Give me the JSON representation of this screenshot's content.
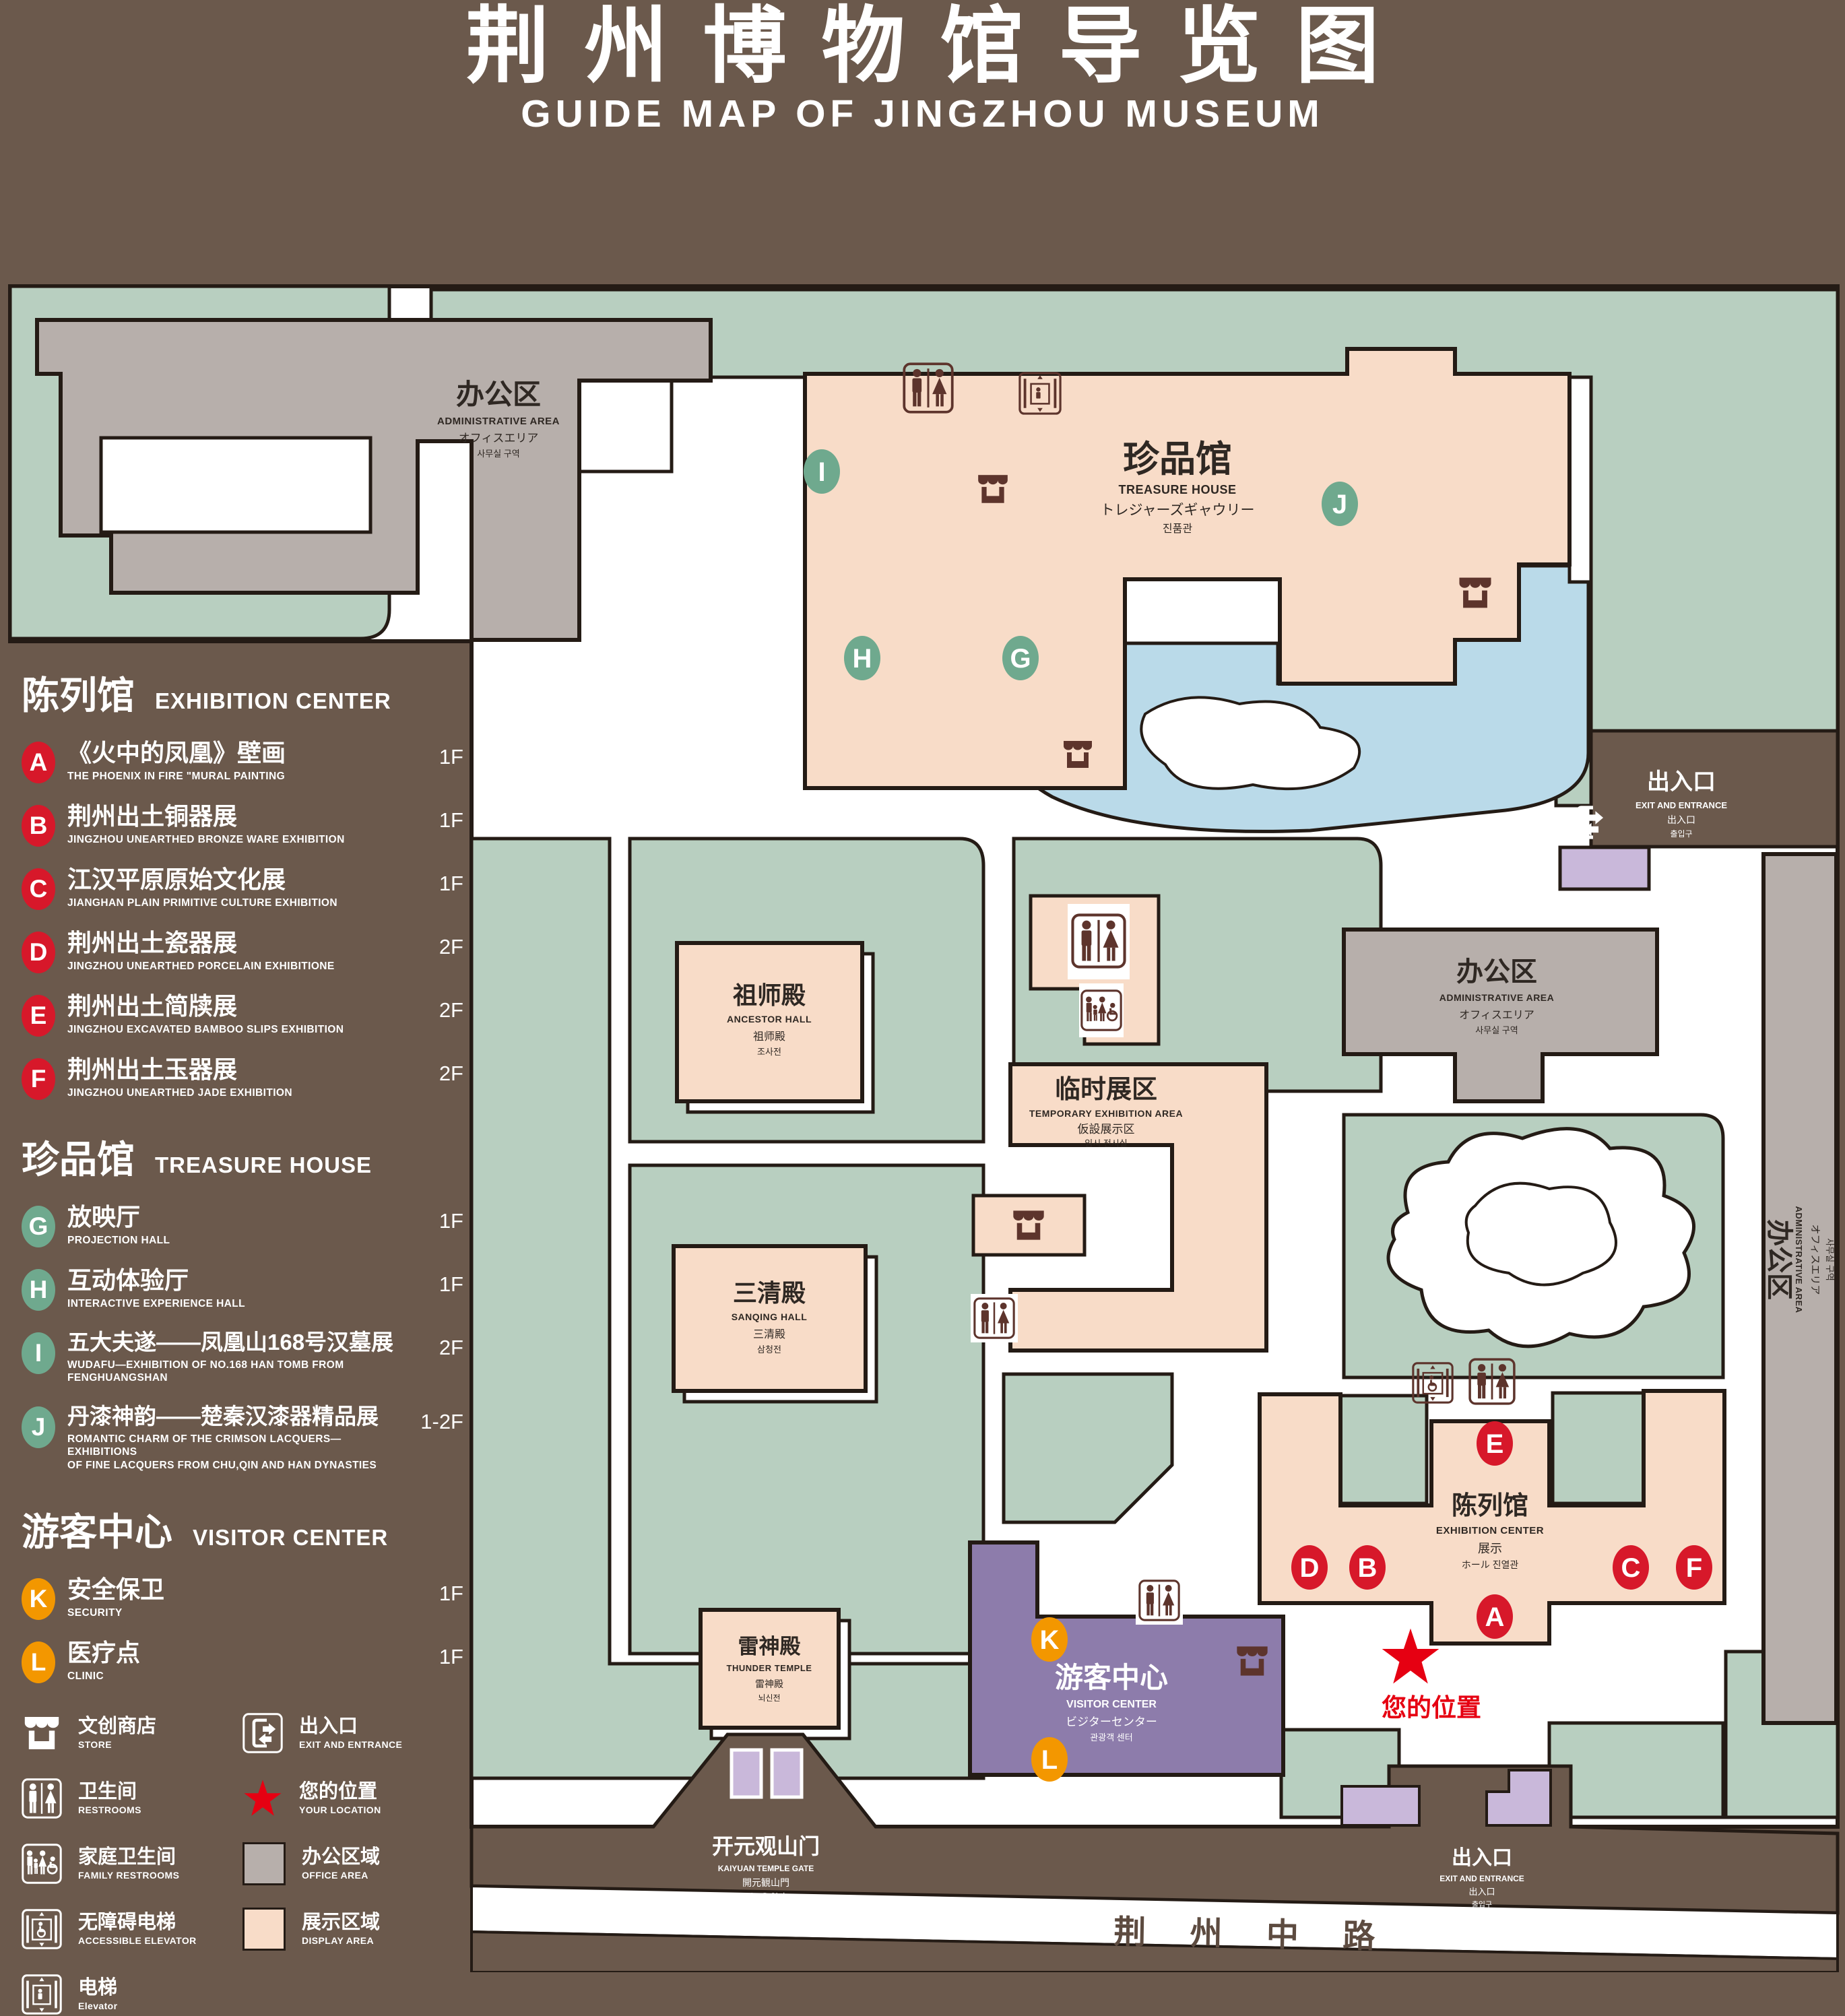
{
  "header": {
    "title": "荆州博物馆导览图",
    "subtitle": "GUIDE MAP OF JINGZHOU MUSEUM"
  },
  "colors": {
    "background_brown": "#6b594c",
    "park_green": "#b8cfc0",
    "display_area_peach": "#f8dcc8",
    "office_area_gray": "#b7afab",
    "visitor_center_purple": "#8d7cab",
    "entrance_lavender": "#c9b8da",
    "pond_blue": "#badae9",
    "badge_red": "#d7182a",
    "badge_green": "#6fa98e",
    "badge_orange": "#f39700",
    "location_red": "#e60012",
    "icon_brown": "#5d342c"
  },
  "legend": {
    "sections": [
      {
        "zh": "陈列馆",
        "en": "EXHIBITION CENTER",
        "items": [
          {
            "letter": "A",
            "title": "《火中的凤凰》壁画",
            "sub": "THE PHOENIX IN FIRE \"MURAL PAINTING",
            "floor": "1F"
          },
          {
            "letter": "B",
            "title": "荆州出土铜器展",
            "sub": "JINGZHOU UNEARTHED BRONZE WARE EXHIBITION",
            "floor": "1F"
          },
          {
            "letter": "C",
            "title": "江汉平原原始文化展",
            "sub": "JIANGHAN PLAIN PRIMITIVE CULTURE EXHIBITION",
            "floor": "1F"
          },
          {
            "letter": "D",
            "title": "荆州出土瓷器展",
            "sub": "JINGZHOU UNEARTHED PORCELAIN EXHIBITIONE",
            "floor": "2F"
          },
          {
            "letter": "E",
            "title": "荆州出土简牍展",
            "sub": "JINGZHOU EXCAVATED BAMBOO SLIPS EXHIBITION",
            "floor": "2F"
          },
          {
            "letter": "F",
            "title": "荆州出土玉器展",
            "sub": "JINGZHOU UNEARTHED JADE EXHIBITION",
            "floor": "2F"
          }
        ]
      },
      {
        "zh": "珍品馆",
        "en": "TREASURE HOUSE",
        "items": [
          {
            "letter": "G",
            "title": "放映厅",
            "sub": "PROJECTION HALL",
            "floor": "1F"
          },
          {
            "letter": "H",
            "title": "互动体验厅",
            "sub": "INTERACTIVE EXPERIENCE HALL",
            "floor": "1F"
          },
          {
            "letter": "I",
            "title": "五大夫遂——凤凰山168号汉墓展",
            "sub": "WUDAFU—EXHIBITION OF NO.168 HAN TOMB FROM FENGHUANGSHAN",
            "floor": "2F"
          },
          {
            "letter": "J",
            "title": "丹漆神韵——楚秦汉漆器精品展",
            "sub": "ROMANTIC CHARM OF THE CRIMSON LACQUERS—EXHIBITIONS",
            "sub2": "OF FINE LACQUERS FROM CHU,QIN AND HAN DYNASTIES",
            "floor": "1-2F"
          }
        ]
      },
      {
        "zh": "游客中心",
        "en": "VISITOR CENTER",
        "items": [
          {
            "letter": "K",
            "title": "安全保卫",
            "sub": "SECURITY",
            "floor": "1F"
          },
          {
            "letter": "L",
            "title": "医疗点",
            "sub": "CLINIC",
            "floor": "1F"
          }
        ]
      }
    ],
    "symbols": [
      {
        "icon": "store-icon",
        "zh": "文创商店",
        "en": "STORE"
      },
      {
        "icon": "restrooms-icon",
        "zh": "卫生间",
        "en": "RESTROOMS"
      },
      {
        "icon": "family-restrooms-icon",
        "zh": "家庭卫生间",
        "en": "FAMILY RESTROOMS"
      },
      {
        "icon": "accessible-elevator-icon",
        "zh": "无障碍电梯",
        "en": "ACCESSIBLE ELEVATOR"
      },
      {
        "icon": "elevator-icon",
        "zh": "电梯",
        "en": "Elevator"
      },
      {
        "icon": "exit-icon",
        "zh": "出入口",
        "en": "EXIT AND ENTRANCE"
      },
      {
        "icon": "your-location-star",
        "zh": "您的位置",
        "en": "YOUR LOCATION"
      },
      {
        "icon": "office-area-swatch",
        "zh": "办公区域",
        "en": "OFFICE AREA"
      },
      {
        "icon": "display-area-swatch",
        "zh": "展示区域",
        "en": "DISPLAY AREA"
      }
    ]
  },
  "map": {
    "markers": {
      "a": "A",
      "b": "B",
      "c": "C",
      "d": "D",
      "e": "E",
      "f": "F",
      "g": "G",
      "h": "H",
      "i": "I",
      "j": "J",
      "k": "K",
      "l": "L"
    },
    "admin": {
      "l1": "办公区",
      "l2": "ADMINISTRATIVE AREA",
      "l3": "オフィスエリア",
      "l4": "사무실 구역"
    },
    "treasure_house": {
      "l1": "珍品馆",
      "l2": "TREASURE HOUSE",
      "l3": "トレジャーズギャウリー",
      "l4": "진품관"
    },
    "ancestor_hall": {
      "l1": "祖师殿",
      "l2": "ANCESTOR HALL",
      "l3": "祖师殿",
      "l4": "조사전"
    },
    "temporary_area": {
      "l1": "临时展区",
      "l2": "TEMPORARY EXHIBITION AREA",
      "l3": "仮設展示区",
      "l4": "임시 전시실"
    },
    "sanqing_hall": {
      "l1": "三清殿",
      "l2": "SANQING HALL",
      "l3": "三清殿",
      "l4": "삼청전"
    },
    "thunder_temple": {
      "l1": "雷神殿",
      "l2": "THUNDER TEMPLE",
      "l3": "雷神殿",
      "l4": "뇌신전"
    },
    "visitor_center": {
      "l1": "游客中心",
      "l2": "VISITOR CENTER",
      "l3": "ビジターセンター",
      "l4": "관광객 센터"
    },
    "exhibition_center": {
      "l1": "陈列馆",
      "l2": "EXHIBITION CENTER",
      "l3": "展示",
      "l4": "ホール 진열관"
    },
    "exit": {
      "l1": "出入口",
      "l2": "EXIT AND ENTRANCE",
      "l3": "出入口",
      "l4": "출입구"
    },
    "gate": {
      "l1": "开元观山门",
      "l2": "KAIYUAN TEMPLE GATE",
      "l3": "開元観山門",
      "l4": "산문을 열다"
    },
    "road_name": "荆 州 中 路",
    "your_location": "您的位置"
  }
}
